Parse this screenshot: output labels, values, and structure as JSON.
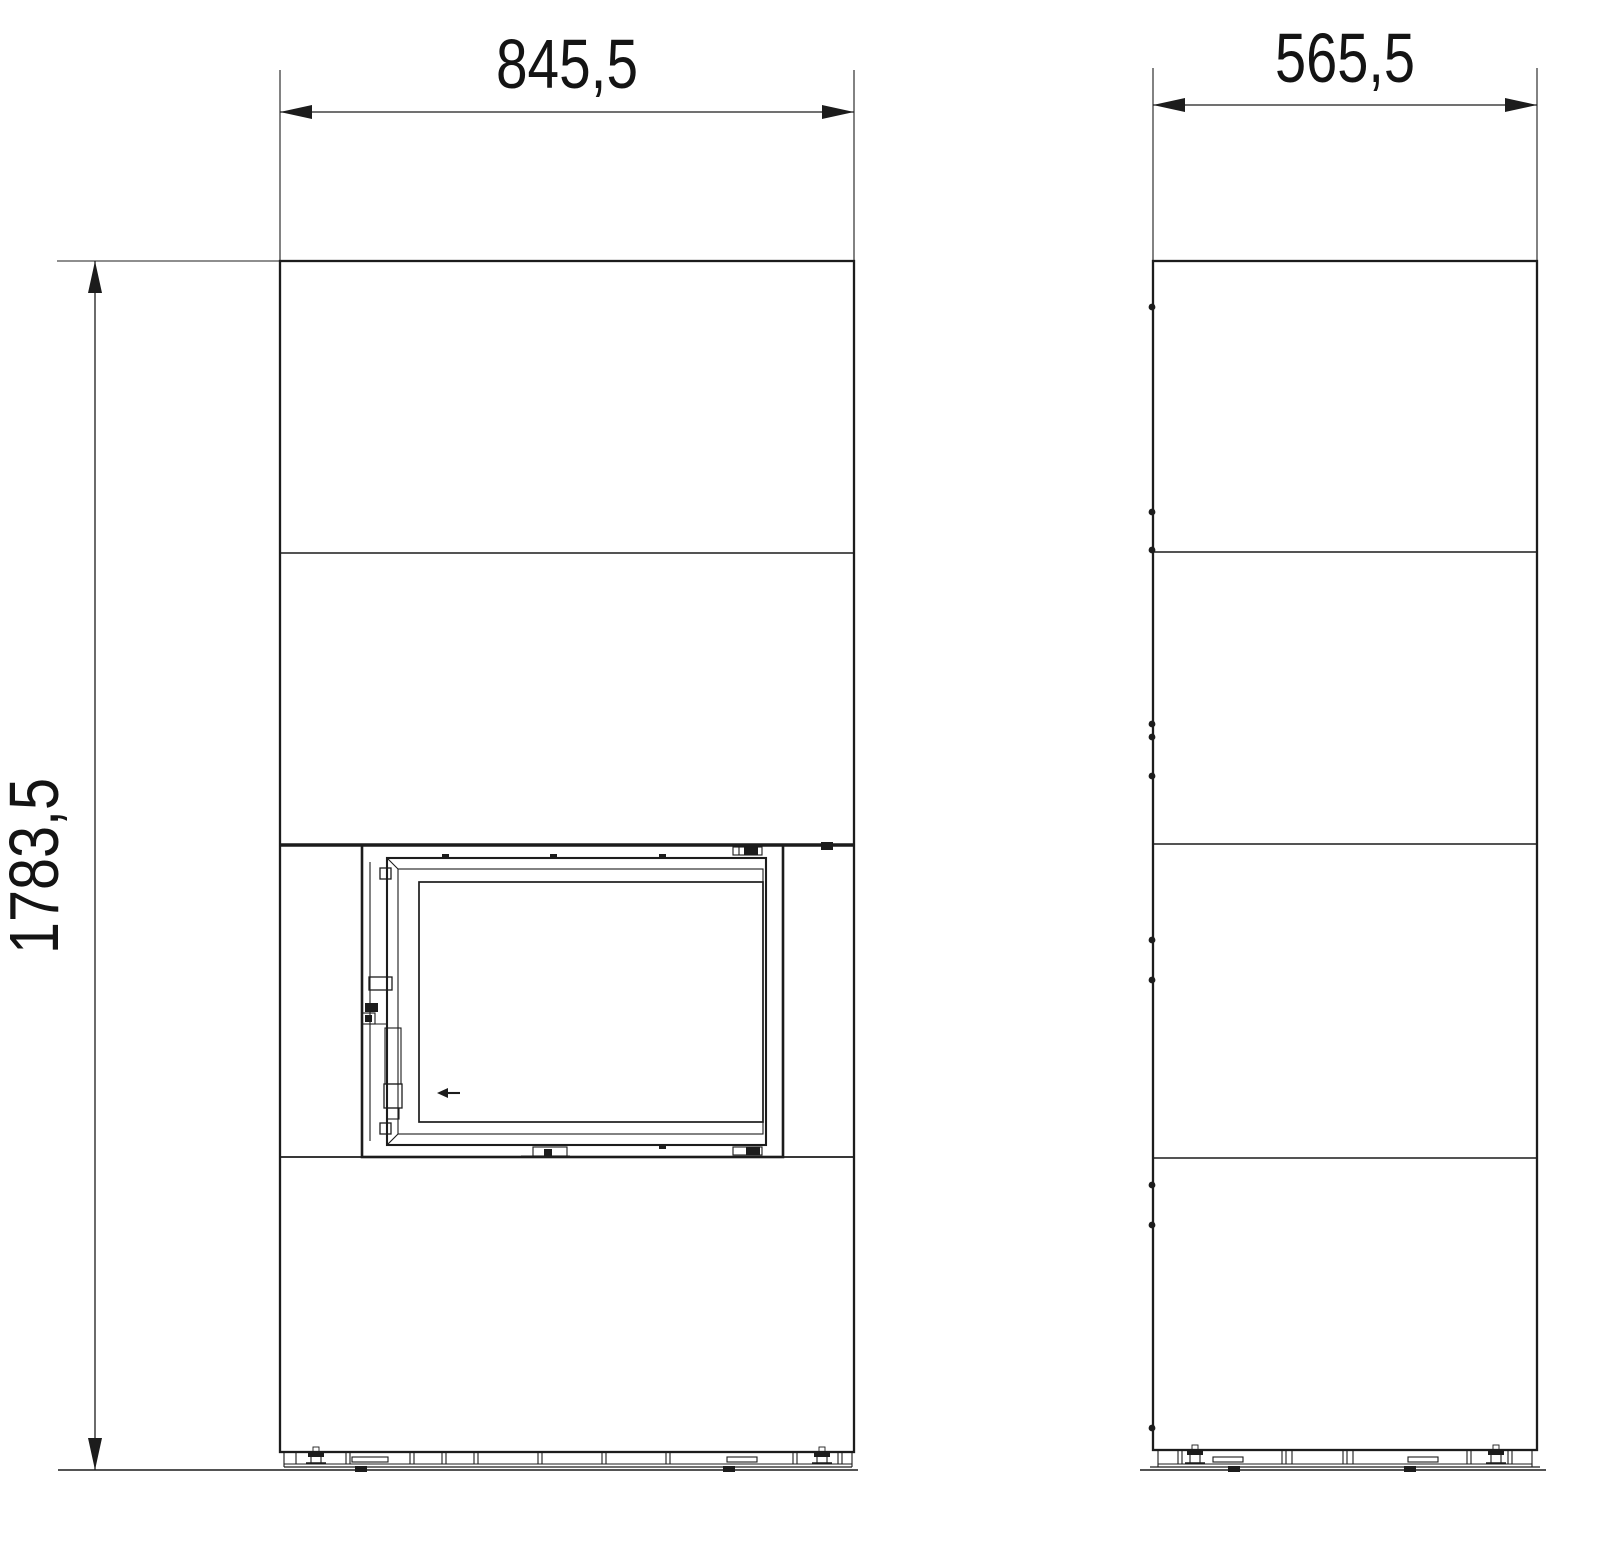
{
  "drawing": {
    "type": "technical-drawing",
    "views": {
      "front_view_name": "front-elevation",
      "side_view_name": "side-elevation"
    },
    "dims": {
      "front_width": "845,5",
      "side_depth": "565,5",
      "height": "1783,5"
    },
    "colors": {
      "line": "#1c1c1c",
      "background": "#ffffff"
    }
  }
}
